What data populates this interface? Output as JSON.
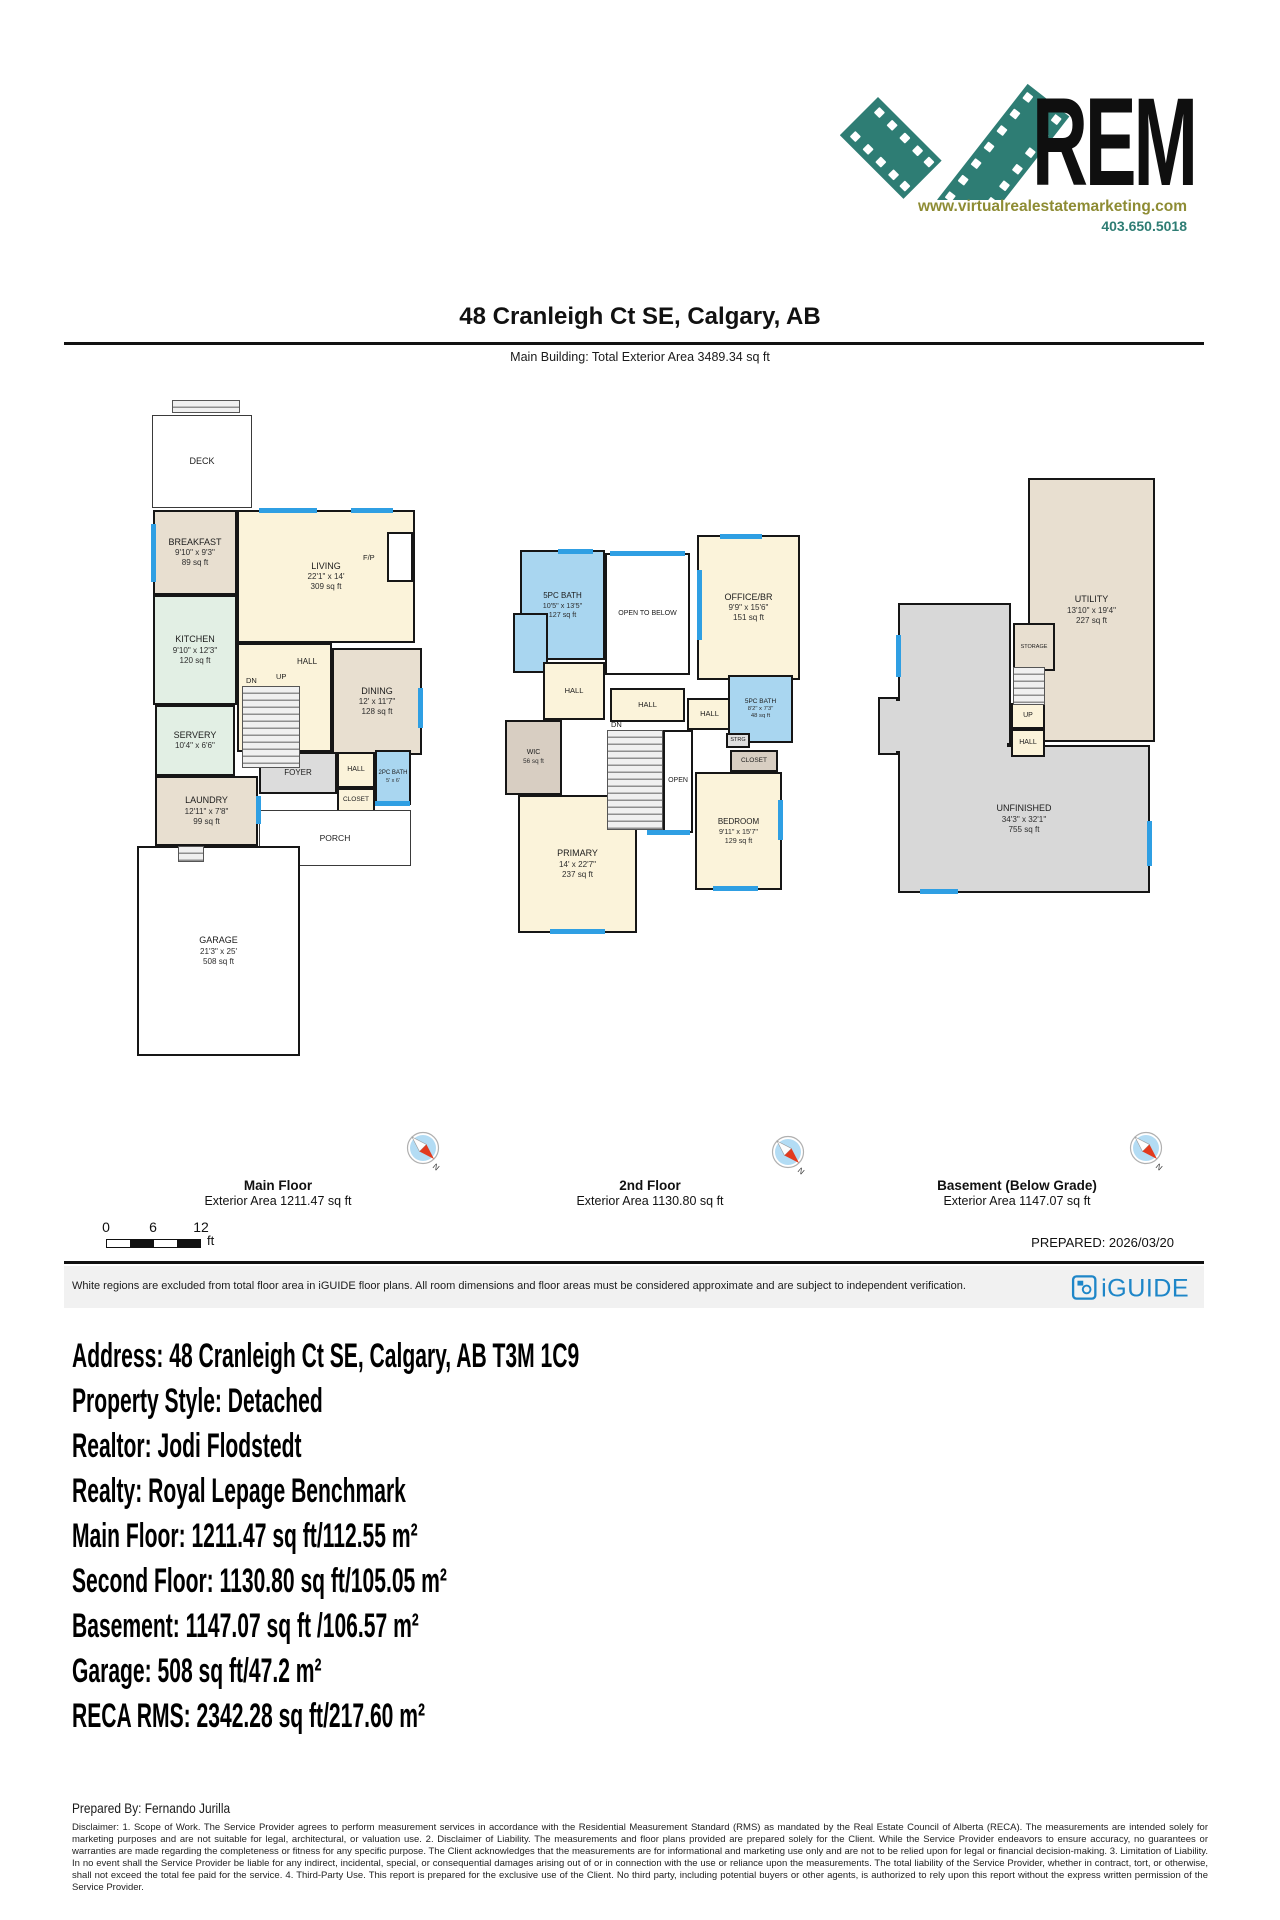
{
  "logo": {
    "brand": "REM",
    "website": "www.virtualrealestatemarketing.com",
    "phone": "403.650.5018",
    "teal": "#2e7d74",
    "olive": "#8e8c34"
  },
  "header": {
    "title": "48 Cranleigh Ct SE, Calgary, AB",
    "subtitle": "Main Building: Total Exterior Area 3489.34 sq ft"
  },
  "colors": {
    "wall": "#161616",
    "window_blue": "#2f9fe3",
    "bath_blue": "#a9d6f0",
    "cream": "#fbf3da",
    "beige": "#e8dfd0",
    "mint": "#e2efe4",
    "gray": "#d8d8d8",
    "iguide_blue": "#1e86c8"
  },
  "floors": [
    {
      "label": "Main Floor",
      "area_label": "Exterior Area 1211.47 sq ft",
      "pos": {
        "x": 135,
        "y": 398,
        "w": 285,
        "h": 665
      },
      "rooms": [
        {
          "label": "DECK",
          "x": 17,
          "y": 17,
          "w": 100,
          "h": 93,
          "bg": "#ffffff",
          "thin": true
        },
        {
          "label": "BREAKFAST",
          "dims": "9'10\" x 9'3\"",
          "area": "89 sq ft",
          "x": 18,
          "y": 112,
          "w": 84,
          "h": 85,
          "bg": "#e8dfd0"
        },
        {
          "label": "LIVING",
          "dims": "22'1\" x 14'",
          "area": "309 sq ft",
          "x": 102,
          "y": 112,
          "w": 178,
          "h": 133,
          "bg": "#fbf3da"
        },
        {
          "label": "",
          "x": 252,
          "y": 134,
          "w": 26,
          "h": 50,
          "bg": "#ffffff"
        },
        {
          "label": "KITCHEN",
          "dims": "9'10\" x 12'3\"",
          "area": "120 sq ft",
          "x": 18,
          "y": 197,
          "w": 84,
          "h": 110,
          "bg": "#e2efe4"
        },
        {
          "label": "HALL",
          "x": 102,
          "y": 245,
          "w": 95,
          "h": 109,
          "bg": "#fbf3da",
          "lp": [
            58,
            12
          ],
          "fs": 8
        },
        {
          "label": "DINING",
          "dims": "12' x 11'7\"",
          "area": "128 sq ft",
          "x": 197,
          "y": 250,
          "w": 90,
          "h": 107,
          "bg": "#e8dfd0"
        },
        {
          "label": "SERVERY",
          "dims": "10'4\" x 6'6\"",
          "x": 20,
          "y": 307,
          "w": 80,
          "h": 71,
          "bg": "#e2efe4"
        },
        {
          "label": "LAUNDRY",
          "dims": "12'11\" x 7'8\"",
          "area": "99 sq ft",
          "x": 20,
          "y": 378,
          "w": 103,
          "h": 70,
          "bg": "#e8dfd0"
        },
        {
          "label": "FOYER",
          "x": 124,
          "y": 354,
          "w": 78,
          "h": 42,
          "bg": "#dcdcdc",
          "fs": 8
        },
        {
          "label": "HALL",
          "x": 202,
          "y": 354,
          "w": 38,
          "h": 36,
          "bg": "#fbf3da",
          "fs": 7
        },
        {
          "label": "CLOSET",
          "x": 202,
          "y": 390,
          "w": 38,
          "h": 24,
          "bg": "#fbf3da",
          "fs": 6.5
        },
        {
          "label": "2PC BATH",
          "dims": "5' x 6'",
          "x": 240,
          "y": 352,
          "w": 36,
          "h": 55,
          "bg": "#a9d6f0",
          "fs": 6
        },
        {
          "label": "PORCH",
          "x": 124,
          "y": 412,
          "w": 152,
          "h": 56,
          "bg": "#ffffff",
          "thin": true,
          "fs": 8.5
        },
        {
          "label": "GARAGE",
          "dims": "21'3\" x 25'",
          "area": "508 sq ft",
          "x": 2,
          "y": 448,
          "w": 163,
          "h": 210,
          "bg": "#ffffff"
        }
      ],
      "stairs": [
        [
          107,
          288,
          58,
          82
        ],
        [
          37,
          2,
          68,
          13
        ],
        [
          43,
          448,
          26,
          16
        ]
      ],
      "windows": [
        [
          16,
          126,
          5,
          58
        ],
        [
          124,
          110,
          58,
          5
        ],
        [
          216,
          110,
          42,
          5
        ],
        [
          283,
          290,
          5,
          40
        ],
        [
          121,
          398,
          5,
          28
        ],
        [
          240,
          403,
          35,
          5
        ]
      ],
      "marks": [
        {
          "t": "F/P",
          "x": 228,
          "y": 155
        },
        {
          "t": "DN",
          "x": 111,
          "y": 278
        },
        {
          "t": "UP",
          "x": 141,
          "y": 274
        }
      ]
    },
    {
      "label": "2nd Floor",
      "area_label": "Exterior Area 1130.80 sq ft",
      "pos": {
        "x": 425,
        "y": 530,
        "w": 378,
        "h": 410
      },
      "rooms": [
        {
          "label": "5PC BATH",
          "dims": "10'5\" x 13'5\"",
          "area": "127 sq ft",
          "x": 95,
          "y": 20,
          "w": 85,
          "h": 110,
          "bg": "#a9d6f0",
          "fs": 8
        },
        {
          "label": "",
          "x": 88,
          "y": 83,
          "w": 35,
          "h": 60,
          "bg": "#a9d6f0"
        },
        {
          "label": "OPEN TO BELOW",
          "x": 180,
          "y": 23,
          "w": 85,
          "h": 122,
          "bg": "#ffffff",
          "fs": 7
        },
        {
          "label": "OFFICE/BR",
          "dims": "9'9\" x 15'6\"",
          "area": "151 sq ft",
          "x": 272,
          "y": 5,
          "w": 103,
          "h": 145,
          "bg": "#fbf3da"
        },
        {
          "label": "HALL",
          "x": 118,
          "y": 132,
          "w": 62,
          "h": 58,
          "bg": "#fbf3da",
          "fs": 7.5
        },
        {
          "label": "HALL",
          "x": 185,
          "y": 158,
          "w": 75,
          "h": 34,
          "bg": "#fbf3da",
          "fs": 7.5
        },
        {
          "label": "HALL",
          "x": 262,
          "y": 168,
          "w": 45,
          "h": 32,
          "bg": "#fbf3da",
          "fs": 7.5
        },
        {
          "label": "WIC",
          "area": "56 sq ft",
          "x": 80,
          "y": 190,
          "w": 57,
          "h": 75,
          "bg": "#d8cec2",
          "fs": 7
        },
        {
          "label": "OPEN",
          "x": 238,
          "y": 200,
          "w": 30,
          "h": 103,
          "bg": "#ffffff",
          "fs": 7
        },
        {
          "label": "5PC BATH",
          "dims": "8'2\" x 7'3\"",
          "area": "48 sq ft",
          "x": 303,
          "y": 145,
          "w": 65,
          "h": 68,
          "bg": "#a9d6f0",
          "fs": 6.5
        },
        {
          "label": "STRG",
          "x": 301,
          "y": 203,
          "w": 24,
          "h": 15,
          "bg": "#e0e0e0",
          "fs": 5.5
        },
        {
          "label": "CLOSET",
          "x": 305,
          "y": 220,
          "w": 48,
          "h": 22,
          "bg": "#d8cec2",
          "fs": 6.5
        },
        {
          "label": "BEDROOM",
          "dims": "9'11\" x 15'7\"",
          "area": "129 sq ft",
          "x": 270,
          "y": 242,
          "w": 87,
          "h": 118,
          "bg": "#fbf3da",
          "fs": 8
        },
        {
          "label": "PRIMARY",
          "dims": "14' x 22'7\"",
          "area": "237 sq ft",
          "x": 93,
          "y": 265,
          "w": 119,
          "h": 138,
          "bg": "#fbf3da"
        }
      ],
      "stairs": [
        [
          182,
          200,
          56,
          100
        ]
      ],
      "windows": [
        [
          133,
          19,
          35,
          5
        ],
        [
          185,
          21,
          75,
          5
        ],
        [
          295,
          4,
          42,
          5
        ],
        [
          272,
          40,
          5,
          70
        ],
        [
          125,
          399,
          55,
          5
        ],
        [
          222,
          300,
          43,
          5
        ],
        [
          288,
          356,
          45,
          5
        ],
        [
          353,
          270,
          5,
          40
        ]
      ],
      "marks": [
        {
          "t": "DN",
          "x": 186,
          "y": 190
        }
      ]
    },
    {
      "label": "Basement (Below Grade)",
      "area_label": "Exterior Area 1147.07 sq ft",
      "pos": {
        "x": 870,
        "y": 475,
        "w": 295,
        "h": 425
      },
      "rooms": [
        {
          "label": "UTILITY",
          "dims": "13'10\" x 19'4\"",
          "area": "227 sq ft",
          "x": 158,
          "y": 3,
          "w": 127,
          "h": 264,
          "bg": "#e8dfd0"
        },
        {
          "label": "",
          "x": 28,
          "y": 128,
          "w": 113,
          "h": 142,
          "bg": "#d8d8d8"
        },
        {
          "label": "UNFINISHED",
          "dims": "34'3\" x 32'1\"",
          "area": "755 sq ft",
          "x": 28,
          "y": 270,
          "w": 252,
          "h": 148,
          "bg": "#d8d8d8"
        },
        {
          "label": "",
          "x": 8,
          "y": 222,
          "w": 20,
          "h": 58,
          "bg": "#d8d8d8"
        },
        {
          "label": "STORAGE",
          "x": 143,
          "y": 148,
          "w": 42,
          "h": 48,
          "bg": "#e8dfd0",
          "fs": 5.5
        },
        {
          "label": "UP",
          "x": 141,
          "y": 228,
          "w": 34,
          "h": 26,
          "bg": "#fbf3da",
          "fs": 7
        },
        {
          "label": "HALL",
          "x": 141,
          "y": 254,
          "w": 34,
          "h": 28,
          "bg": "#fbf3da",
          "fs": 7
        }
      ],
      "patches": [
        [
          31,
          266,
          106,
          8
        ],
        [
          25,
          226,
          8,
          50
        ]
      ],
      "stairs": [
        [
          143,
          192,
          32,
          38
        ]
      ],
      "windows": [
        [
          26,
          160,
          5,
          42
        ],
        [
          277,
          346,
          5,
          45
        ],
        [
          50,
          414,
          38,
          5
        ]
      ],
      "marks": []
    }
  ],
  "scale_bar": {
    "ticks": [
      "0",
      "6",
      "12"
    ],
    "unit": "ft"
  },
  "prepared": "PREPARED: 2026/03/20",
  "footer_bar": {
    "disclaimer": "White regions are excluded from total floor area in iGUIDE floor plans. All room dimensions and floor areas must be considered approximate and are subject to independent verification.",
    "brand": "iGUIDE"
  },
  "details": {
    "lines": [
      "Address: 48 Cranleigh Ct SE, Calgary, AB T3M 1C9",
      "Property Style: Detached",
      "Realtor: Jodi Flodstedt",
      "Realty: Royal Lepage Benchmark",
      "Main Floor: 1211.47 sq ft/112.55 m²",
      "Second Floor: 1130.80 sq ft/105.05 m²",
      "Basement: 1147.07 sq ft /106.57 m²",
      "Garage: 508 sq ft/47.2 m²",
      "RECA RMS: 2342.28 sq ft/217.60 m²"
    ]
  },
  "prepared_by": "Prepared By: Fernando Jurilla",
  "legal": "Disclaimer: 1. Scope of Work. The Service Provider agrees to perform measurement services in accordance with the Residential Measurement Standard (RMS) as mandated by the Real Estate Council of Alberta (RECA). The measurements are intended solely for marketing purposes and are not suitable for legal, architectural, or valuation use. 2. Disclaimer of Liability. The measurements and floor plans provided are prepared solely for the Client. While the Service Provider endeavors to ensure accuracy, no guarantees or warranties are made regarding the completeness or fitness for any specific purpose. The Client acknowledges that the measurements are for informational and marketing use only and are not to be relied upon for legal or financial decision-making. 3. Limitation of Liability. In no event shall the Service Provider be liable for any indirect, incidental, special, or consequential damages arising out of or in connection with the use or reliance upon the measurements. The total liability of the Service Provider, whether in contract, tort, or otherwise, shall not exceed the total fee paid for the service. 4. Third-Party Use. This report is prepared for the exclusive use of the Client. No third party, including potential buyers or other agents, is authorized to rely upon this report without the express written permission of the Service Provider."
}
